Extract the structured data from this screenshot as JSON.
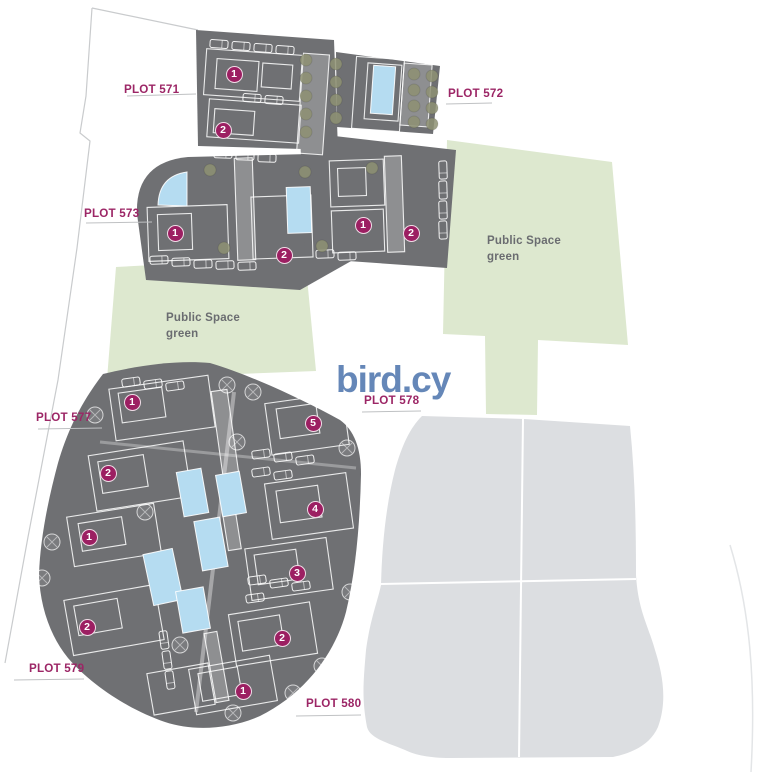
{
  "watermark": {
    "text": "bird.cy"
  },
  "colors": {
    "plot_label_magenta": "#9c2666",
    "badge_magenta": "#9c1f62",
    "building_block_gray": "#6f7073",
    "public_green": "#dde8cf",
    "pool_blue": "#b5dcf1",
    "future_plot_gray": "#dcdee1",
    "watermark_blue": "#5d81b4",
    "tree_olive": "#8e9173"
  },
  "plot_labels": [
    {
      "id": "571",
      "text": "PLOT 571",
      "x": 124,
      "y": 82
    },
    {
      "id": "572",
      "text": "PLOT 572",
      "x": 448,
      "y": 86
    },
    {
      "id": "573",
      "text": "PLOT 573",
      "x": 84,
      "y": 206
    },
    {
      "id": "577",
      "text": "PLOT 577",
      "x": 36,
      "y": 410
    },
    {
      "id": "578",
      "text": "PLOT 578",
      "x": 364,
      "y": 393
    },
    {
      "id": "579",
      "text": "PLOT 579",
      "x": 29,
      "y": 661
    },
    {
      "id": "580",
      "text": "PLOT 580",
      "x": 306,
      "y": 696
    }
  ],
  "public_space_labels": [
    {
      "line1": "Public Space",
      "line2": "green",
      "x": 487,
      "y": 234
    },
    {
      "line1": "Public Space",
      "line2": "green",
      "x": 166,
      "y": 311
    }
  ],
  "unit_badges": [
    {
      "num": "1",
      "x": 234,
      "y": 74
    },
    {
      "num": "2",
      "x": 223,
      "y": 130
    },
    {
      "num": "1",
      "x": 175,
      "y": 233
    },
    {
      "num": "2",
      "x": 284,
      "y": 255
    },
    {
      "num": "1",
      "x": 363,
      "y": 225
    },
    {
      "num": "2",
      "x": 411,
      "y": 233
    },
    {
      "num": "1",
      "x": 132,
      "y": 402
    },
    {
      "num": "2",
      "x": 108,
      "y": 473
    },
    {
      "num": "1",
      "x": 89,
      "y": 537
    },
    {
      "num": "2",
      "x": 87,
      "y": 627
    },
    {
      "num": "5",
      "x": 313,
      "y": 423
    },
    {
      "num": "4",
      "x": 315,
      "y": 509
    },
    {
      "num": "3",
      "x": 297,
      "y": 573
    },
    {
      "num": "2",
      "x": 282,
      "y": 638
    },
    {
      "num": "1",
      "x": 243,
      "y": 691
    }
  ]
}
